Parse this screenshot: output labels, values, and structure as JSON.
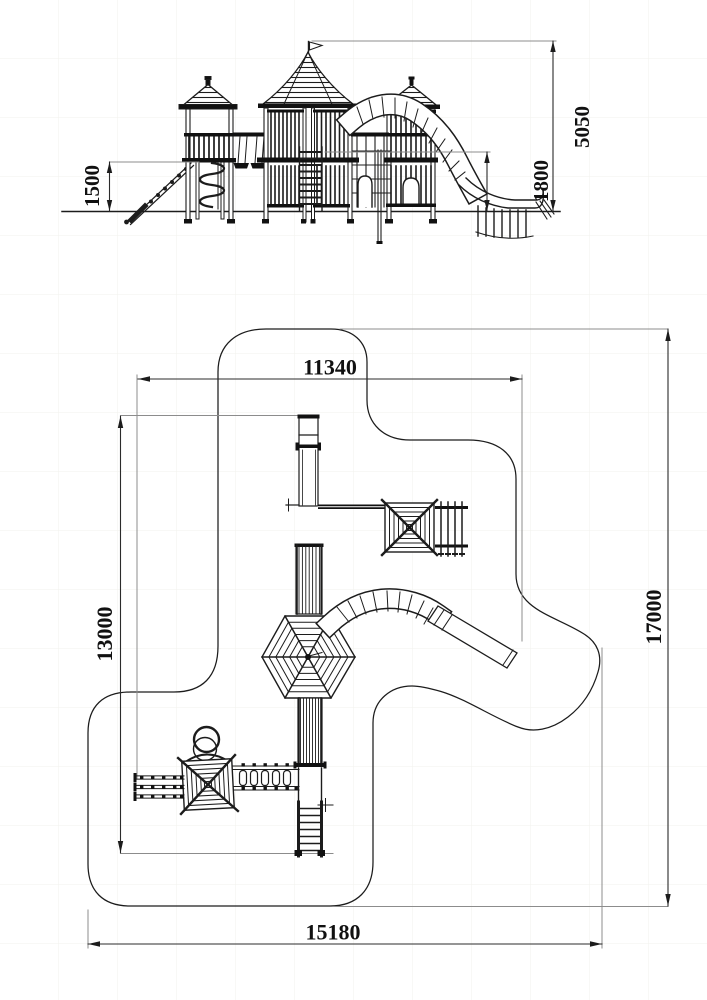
{
  "drawing": {
    "background": "#ffffff",
    "line_color": "#1c1c1c",
    "extension_line_color": "#8c8c8c",
    "views": {
      "elevation": {
        "name": "front-elevation",
        "dims": {
          "ramp_height": "1500",
          "total_height": "5050",
          "slide_height": "1800"
        }
      },
      "plan": {
        "name": "site-plan",
        "dims": {
          "top_width": "11340",
          "left_height": "13000",
          "right_height": "17000",
          "bottom_width": "15180"
        }
      }
    }
  }
}
